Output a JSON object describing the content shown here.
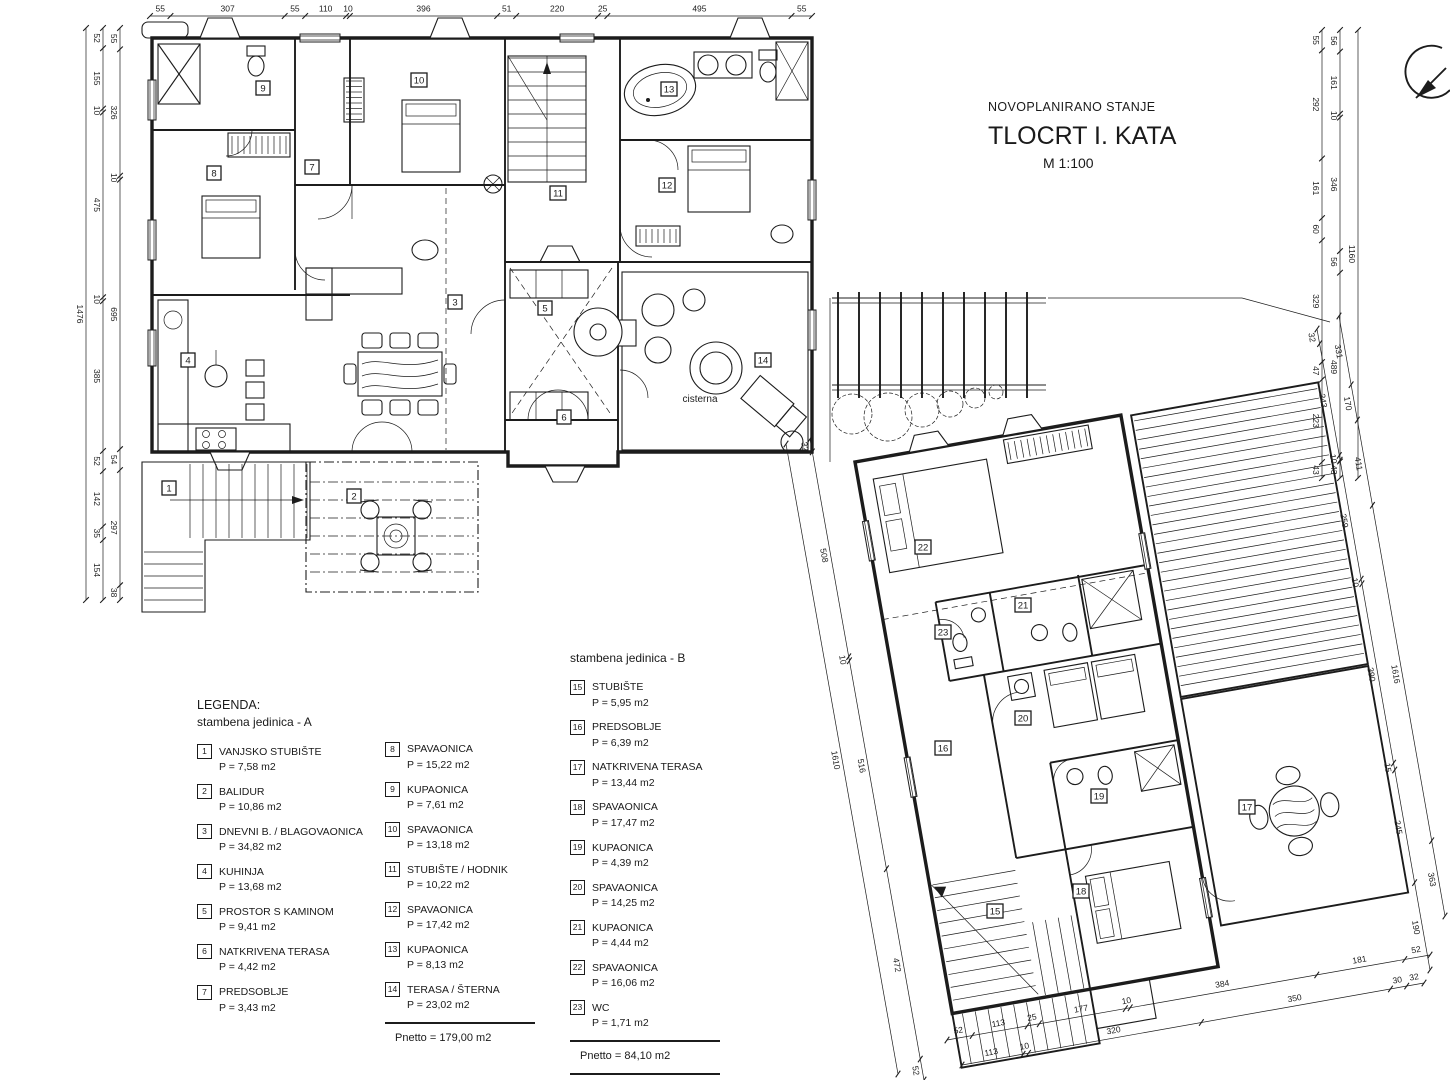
{
  "title": {
    "line1": "NOVOPLANIRANO STANJE",
    "line2": "TLOCRT I. KATA",
    "line3": "M 1:100"
  },
  "legend": {
    "heading": "LEGENDA:",
    "unitA_heading": "stambena jedinica - A",
    "unitB_heading": "stambena jedinica - B",
    "rooms": [
      {
        "num": "1",
        "name": "VANJSKO STUBIŠTE",
        "area": "P = 7,58 m2"
      },
      {
        "num": "2",
        "name": "BALIDUR",
        "area": "P = 10,86 m2"
      },
      {
        "num": "3",
        "name": "DNEVNI B. / BLAGOVAONICA",
        "area": "P = 34,82 m2"
      },
      {
        "num": "4",
        "name": "KUHINJA",
        "area": "P = 13,68 m2"
      },
      {
        "num": "5",
        "name": "PROSTOR S KAMINOM",
        "area": "P = 9,41 m2"
      },
      {
        "num": "6",
        "name": "NATKRIVENA TERASA",
        "area": "P = 4,42 m2"
      },
      {
        "num": "7",
        "name": "PREDSOBLJE",
        "area": "P = 3,43 m2"
      },
      {
        "num": "8",
        "name": "SPAVAONICA",
        "area": "P = 15,22 m2"
      },
      {
        "num": "9",
        "name": "KUPAONICA",
        "area": "P = 7,61 m2"
      },
      {
        "num": "10",
        "name": "SPAVAONICA",
        "area": "P = 13,18 m2"
      },
      {
        "num": "11",
        "name": "STUBIŠTE / HODNIK",
        "area": "P = 10,22 m2"
      },
      {
        "num": "12",
        "name": "SPAVAONICA",
        "area": "P = 17,42 m2"
      },
      {
        "num": "13",
        "name": "KUPAONICA",
        "area": "P = 8,13 m2"
      },
      {
        "num": "14",
        "name": "TERASA / ŠTERNA",
        "area": "P = 23,02 m2"
      },
      {
        "num": "15",
        "name": "STUBIŠTE",
        "area": "P = 5,95 m2"
      },
      {
        "num": "16",
        "name": "PREDSOBLJE",
        "area": "P = 6,39 m2"
      },
      {
        "num": "17",
        "name": "NATKRIVENA TERASA",
        "area": "P = 13,44 m2"
      },
      {
        "num": "18",
        "name": "SPAVAONICA",
        "area": "P = 17,47 m2"
      },
      {
        "num": "19",
        "name": "KUPAONICA",
        "area": "P = 4,39 m2"
      },
      {
        "num": "20",
        "name": "SPAVAONICA",
        "area": "P = 14,25 m2"
      },
      {
        "num": "21",
        "name": "KUPAONICA",
        "area": "P = 4,44 m2"
      },
      {
        "num": "22",
        "name": "SPAVAONICA",
        "area": "P = 16,06 m2"
      },
      {
        "num": "23",
        "name": "WC",
        "area": "P = 1,71 m2"
      }
    ],
    "unitA_subtotal": "Pnetto = 179,00 m2",
    "unitB_subtotal": "Pnetto = 84,10 m2",
    "total_net": "Pnetto ukupno = 263,10 m2",
    "total_gross": "Pbrutto ukupno= 344,05 m2"
  },
  "plan": {
    "cisterna_label": "cisterna"
  },
  "dimensions": {
    "chains": [
      {
        "p1": [
          150,
          16
        ],
        "p2": [
          812,
          16
        ],
        "side": 1,
        "values": [
          "55",
          "307",
          "55",
          "110",
          "10",
          "396",
          "51",
          "220",
          "25",
          "495",
          "55"
        ]
      },
      {
        "p1": [
          86,
          28
        ],
        "p2": [
          86,
          600
        ],
        "side": -1,
        "values": [
          "1476"
        ]
      },
      {
        "p1": [
          103,
          28
        ],
        "p2": [
          103,
          600
        ],
        "side": -1,
        "values": [
          "52",
          "155",
          "10",
          "475",
          "10",
          "385",
          "52",
          "142",
          "35",
          "154"
        ]
      },
      {
        "p1": [
          120,
          28
        ],
        "p2": [
          120,
          600
        ],
        "side": -1,
        "values": [
          "55",
          "326",
          "10",
          "695",
          "54",
          "297",
          "38"
        ]
      },
      {
        "p1": [
          1322,
          30
        ],
        "p2": [
          1322,
          478
        ],
        "side": -1,
        "values": [
          "55",
          "292",
          "161",
          "60",
          "329",
          "47",
          "223",
          "43"
        ]
      },
      {
        "p1": [
          1340,
          30
        ],
        "p2": [
          1340,
          478
        ],
        "side": -1,
        "values": [
          "56",
          "161",
          "10",
          "346",
          "56",
          "489",
          "43"
        ]
      },
      {
        "p1": [
          1358,
          30
        ],
        "p2": [
          1358,
          478
        ],
        "side": -1,
        "values": [
          "1160"
        ]
      },
      {
        "p1": [
          810,
          439
        ],
        "p2": [
          924,
          1080
        ],
        "side": -1,
        "values": [
          "32",
          "508",
          "10",
          "516",
          "472",
          "52"
        ]
      },
      {
        "p1": [
          786,
          444
        ],
        "p2": [
          898,
          1074
        ],
        "side": -1,
        "values": [
          "1610"
        ]
      },
      {
        "p1": [
          1317,
          329
        ],
        "p2": [
          1430,
          970
        ],
        "side": -1,
        "values": [
          "32",
          "243",
          "10",
          "259",
          "10",
          "390",
          "15",
          "245",
          "190"
        ]
      },
      {
        "p1": [
          1339,
          316
        ],
        "p2": [
          1445,
          916
        ],
        "side": -1,
        "values": [
          "331",
          "170",
          "411",
          "1616",
          "363"
        ]
      },
      {
        "p1": [
          947,
          1040
        ],
        "p2": [
          1430,
          955
        ],
        "side": 1,
        "values": [
          "52",
          "113",
          "25",
          "177",
          "10",
          "384",
          "181",
          "52"
        ]
      },
      {
        "p1": [
          962,
          1065
        ],
        "p2": [
          1424,
          983
        ],
        "side": 1,
        "values": [
          "113",
          "10",
          "320",
          "350",
          "30",
          "32"
        ]
      }
    ]
  }
}
